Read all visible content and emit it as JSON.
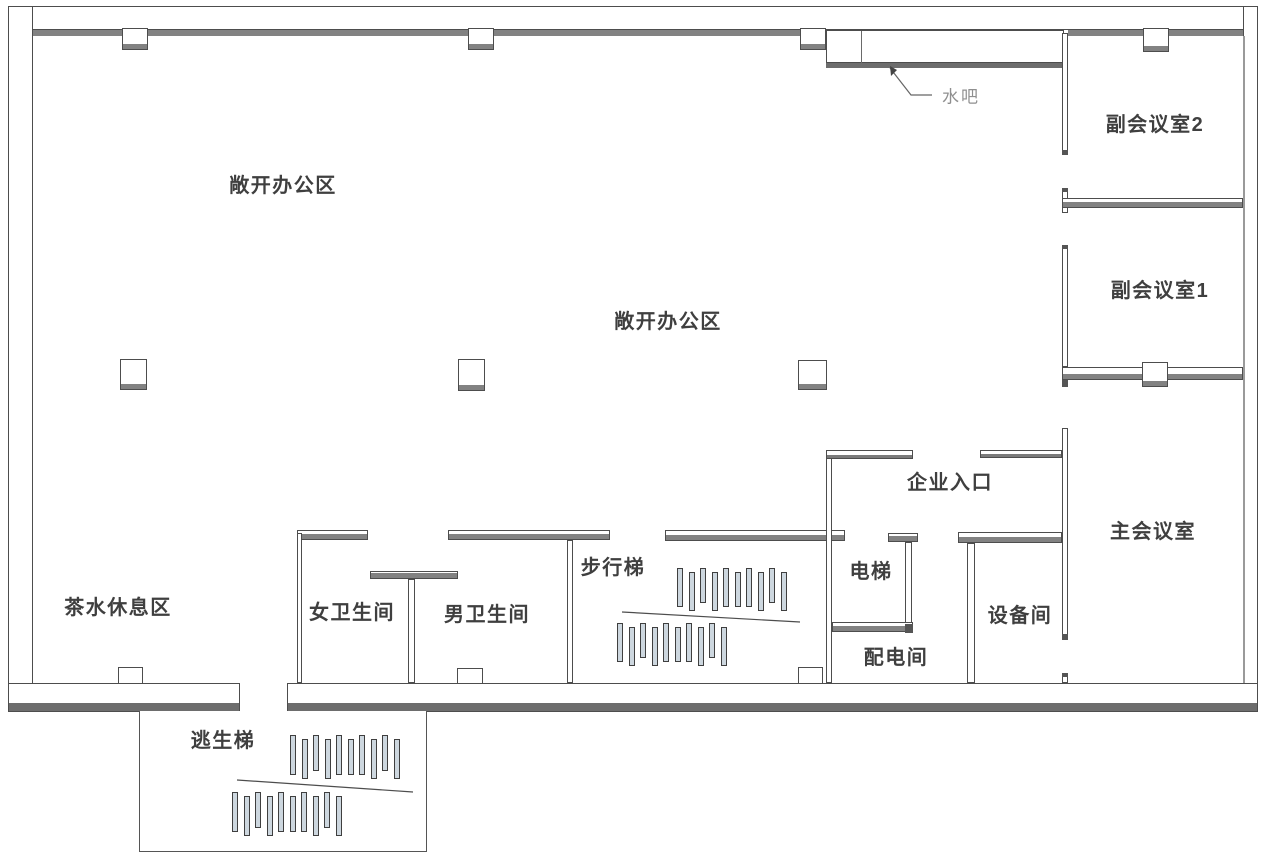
{
  "colors": {
    "wall_outline": "#4d4d4d",
    "wall_band_gray": "#828282",
    "dark_band": "#6d6d6d",
    "tread_fill": "#cdd7df",
    "label_text": "#3f3f3f",
    "secondary_text": "#8f8f8f"
  },
  "labels": {
    "open_office_1": "敞开办公区",
    "open_office_2": "敞开办公区",
    "tea_lounge": "茶水休息区",
    "womens_restroom": "女卫生间",
    "mens_restroom": "男卫生间",
    "walking_stairs": "步行梯",
    "escape_stairs": "逃生梯",
    "elevator": "电梯",
    "power_distribution_room": "配电间",
    "equipment_room": "设备间",
    "enterprise_entrance": "企业入口",
    "main_meeting_room": "主会议室",
    "sub_meeting_room_2": "副会议室2",
    "sub_meeting_room_1": "副会议室1",
    "water_bar": "水吧"
  },
  "stairs": {
    "walking": {
      "upper_treads": 10,
      "lower_treads": 10
    },
    "escape": {
      "upper_treads": 10,
      "lower_treads": 10
    }
  }
}
